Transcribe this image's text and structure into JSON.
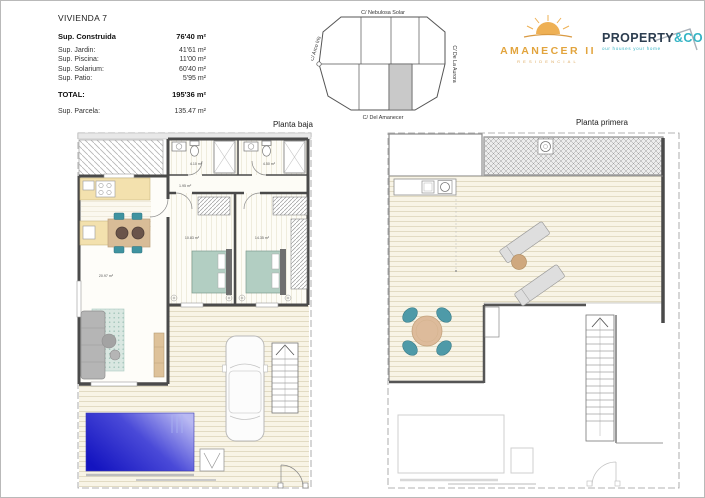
{
  "info": {
    "title": "VIVIENDA 7",
    "construida": {
      "label": "Sup. Construida",
      "value": "76'40 m²"
    },
    "rows": [
      {
        "label": "Sup. Jardin:",
        "value": "41'61 m²"
      },
      {
        "label": "Sup. Piscina:",
        "value": "11'00 m²"
      },
      {
        "label": "Sup. Solarium:",
        "value": "60'40 m²"
      },
      {
        "label": "Sup. Patio:",
        "value": "5'95 m²"
      }
    ],
    "total": {
      "label": "TOTAL:",
      "value": "195'36 m²"
    },
    "parcela": {
      "label": "Sup. Parcela:",
      "value": "135.47 m²"
    }
  },
  "site": {
    "street_top": "C/ Nebulosa Solar",
    "street_bottom": "C/ Del Amanecer",
    "street_left": "C/ Arco Iris",
    "street_right": "C/ De La Aurora"
  },
  "brands": {
    "amanecer": {
      "name": "AMANECER II",
      "sub": "RESIDENCIAL",
      "color": "#E2A43D"
    },
    "property": {
      "name": "PROPERTY",
      "suffix": "&CO",
      "tagline": "our houses your home",
      "dark": "#2D3E50",
      "teal": "#35B4C5"
    }
  },
  "plans": {
    "ground": {
      "title": "Planta baja",
      "labels": {
        "bath1": "4.10 m²",
        "bath2": "4.50 m²",
        "hall": "1.95 m²",
        "bed1": "10.83 m²",
        "bed2": "14.35 m²",
        "living": "20.97 m²"
      }
    },
    "first": {
      "title": "Planta primera"
    }
  },
  "palette": {
    "wall": "#4a4a4a",
    "pool_dark": "#1414c0",
    "pool_light": "#b9b9f2",
    "counter": "#f3e1ae",
    "chair_teal": "#4e9aa8",
    "bed": "#b2cec2",
    "table_wood": "#d8bc97",
    "site_highlight": "#c9c9c9"
  }
}
